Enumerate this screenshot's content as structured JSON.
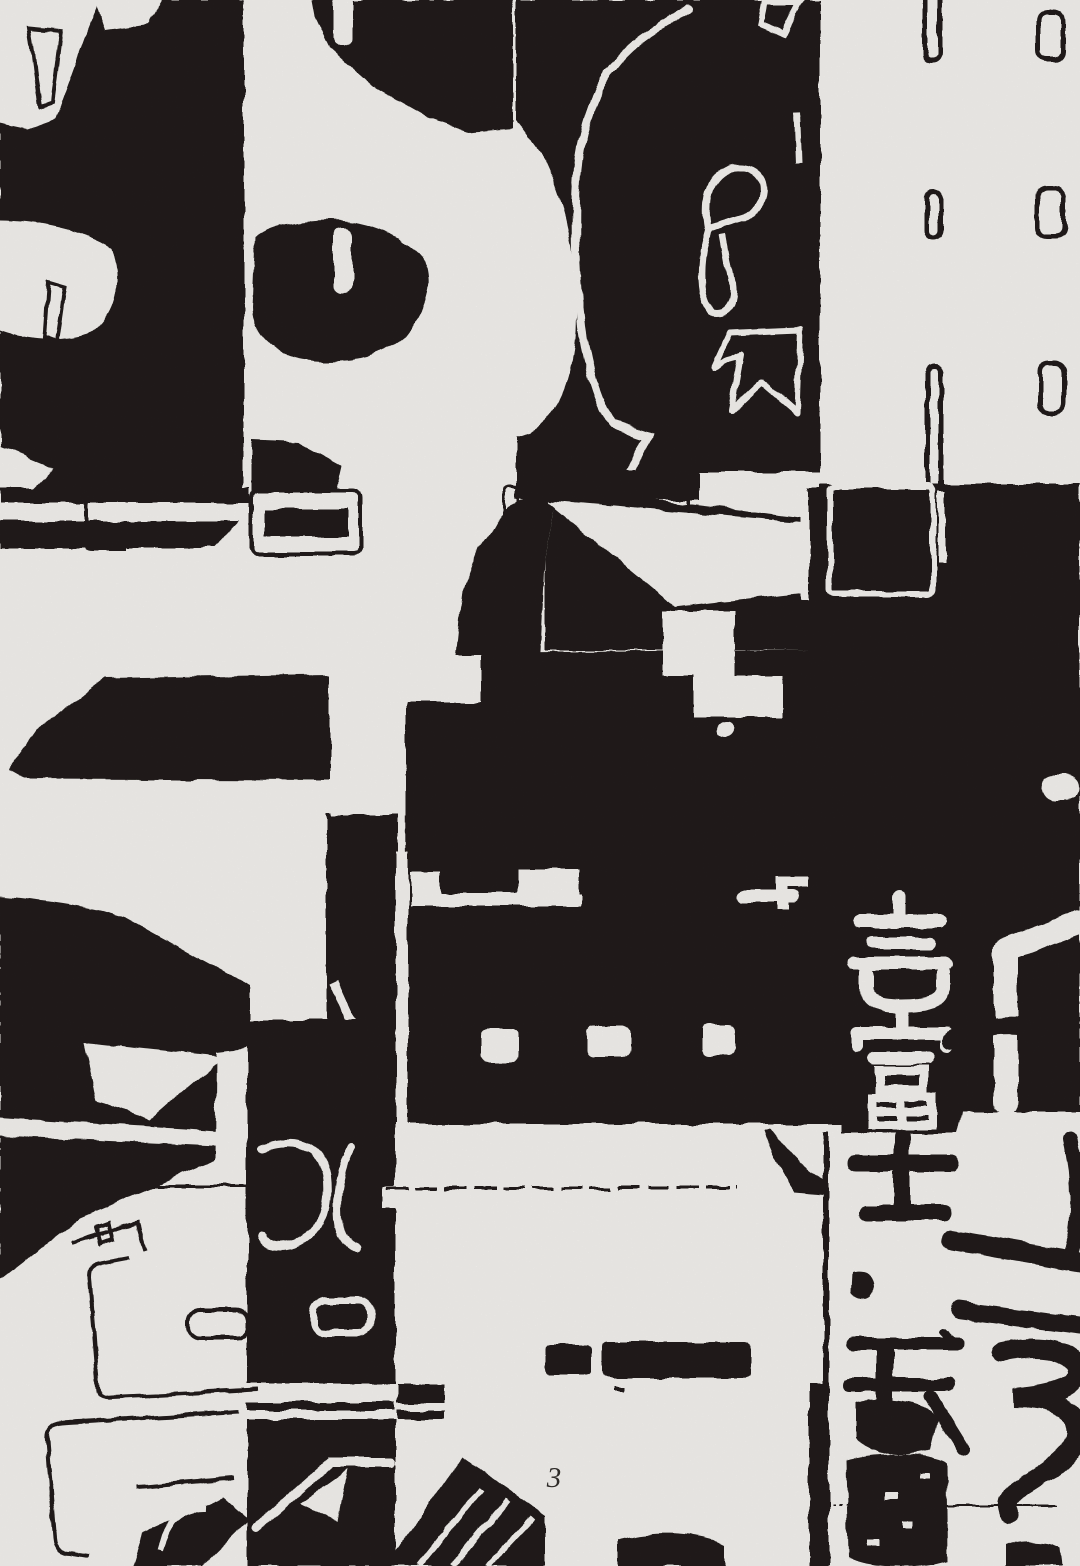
{
  "colors": {
    "ink": "#221f1c",
    "paper": "#f8f6f3"
  },
  "artwork": {
    "column_text": "壱富士、弐鷹",
    "kanji_column": [
      {
        "char": "壱",
        "rendering": "white-on-black"
      },
      {
        "char": "富",
        "rendering": "white-on-black"
      },
      {
        "char": "士",
        "rendering": "black-on-white"
      },
      {
        "char": "、",
        "rendering": "black-on-white"
      },
      {
        "char": "弐",
        "rendering": "black-on-white"
      },
      {
        "char": "鷹",
        "rendering": "black-on-white"
      }
    ]
  },
  "footer": {
    "page_number": "3"
  }
}
